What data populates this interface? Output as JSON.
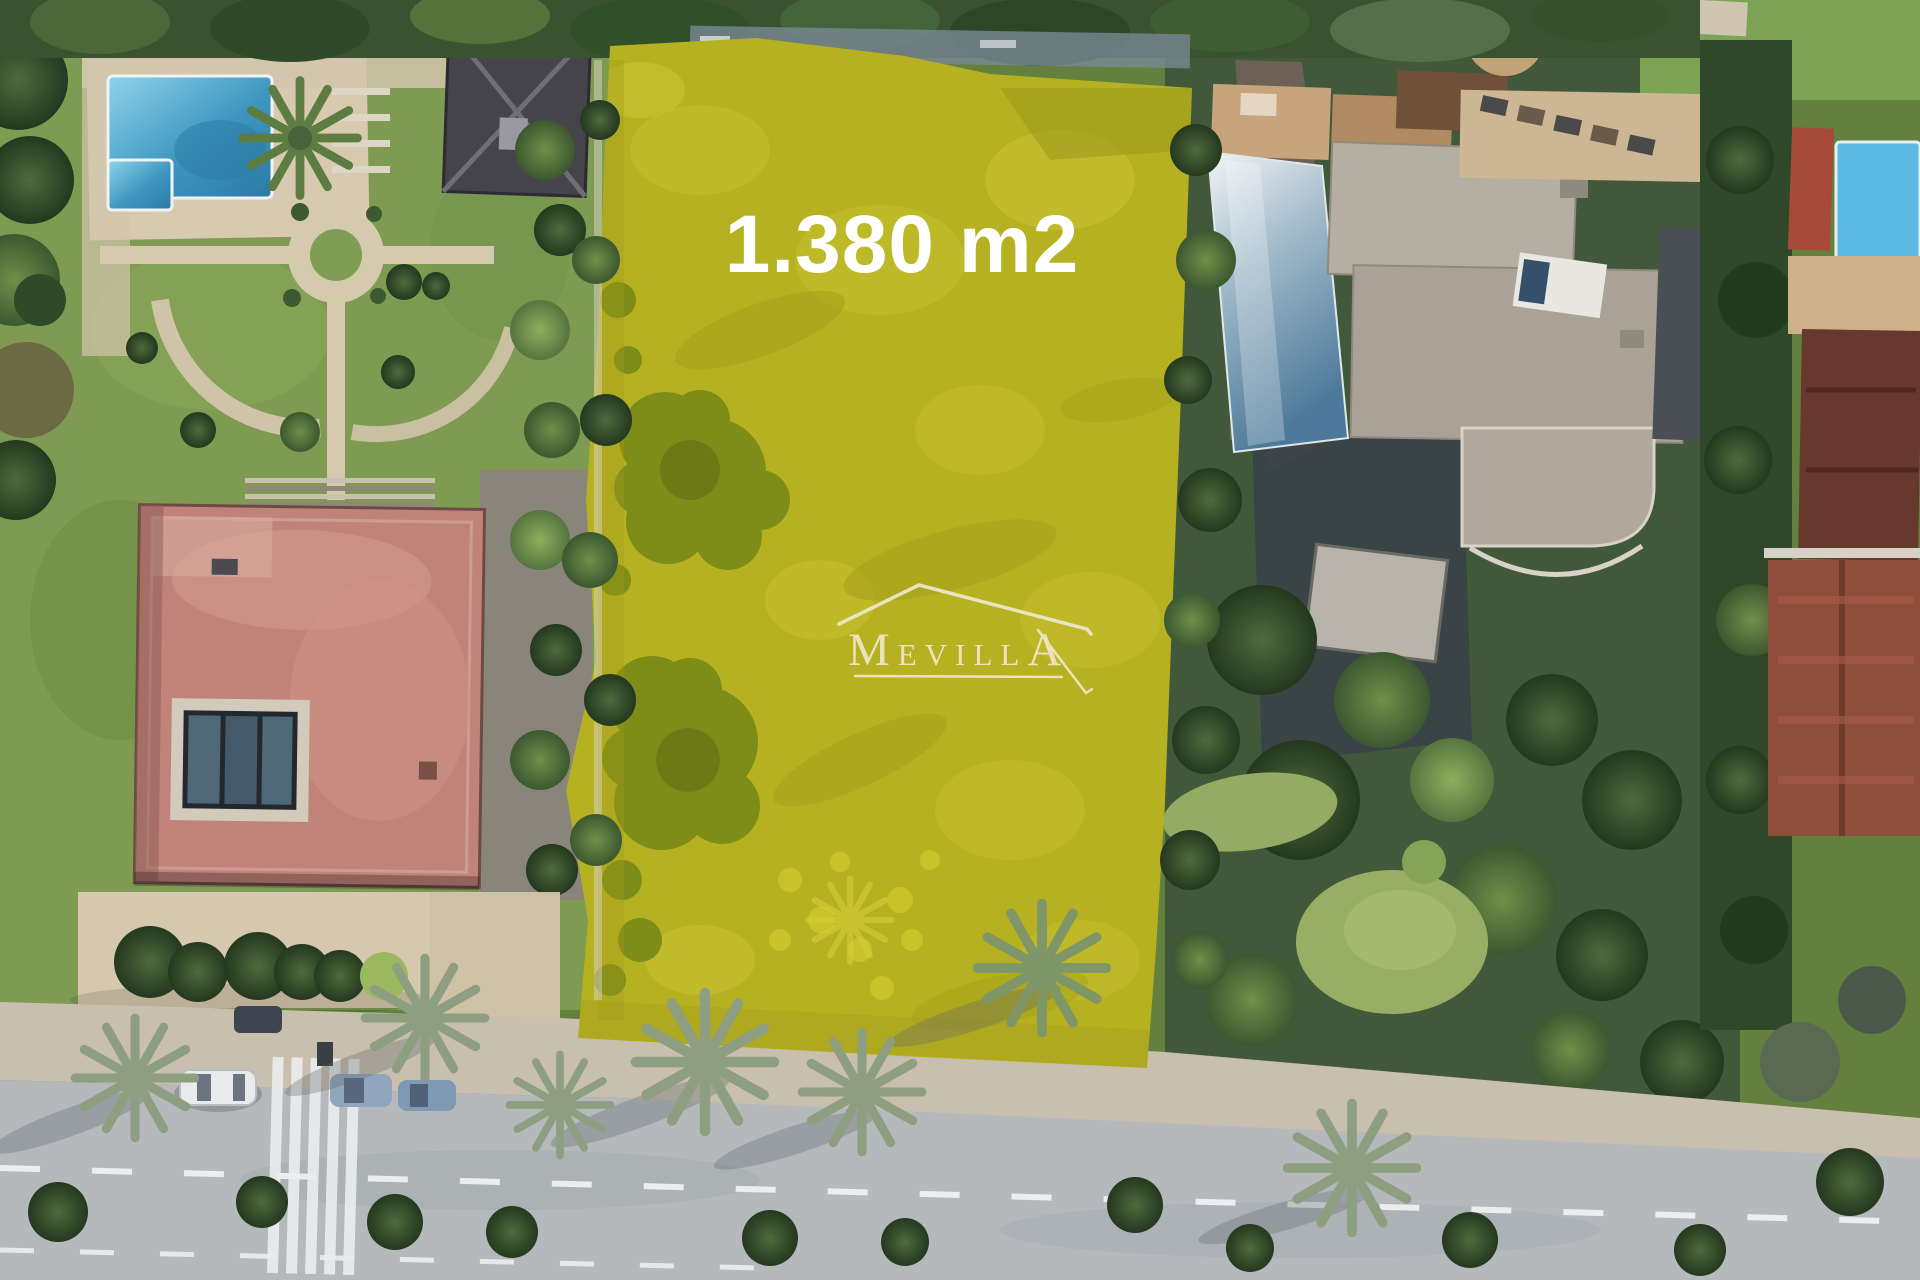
{
  "plot": {
    "area_label": "1.380 m2"
  },
  "watermark": {
    "text": "MEVILLA",
    "part_m": "M",
    "part_mid": "EVILL",
    "part_a": "A"
  },
  "colors": {
    "highlight": "#b6b120",
    "area_label_text": "#ffffff",
    "watermark": "#ede8c8",
    "pool_water": "#5cb9e4"
  }
}
